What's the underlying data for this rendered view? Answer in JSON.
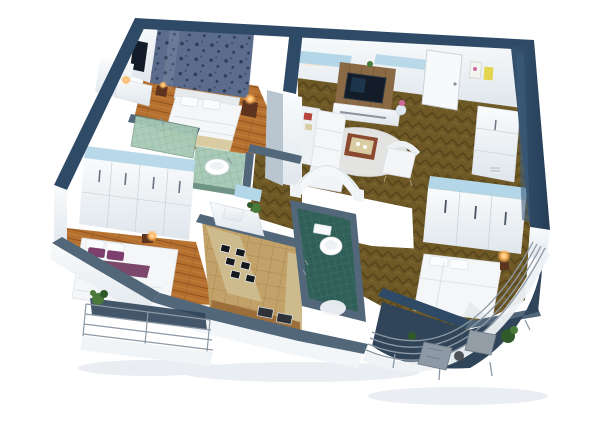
{
  "scene": {
    "title": "3D cutaway floor plan render of a three-bedroom apartment",
    "view": "aerial isometric cutaway, white background",
    "rooms": [
      {
        "id": "bedroom-main",
        "desc": "bedroom with dark patterned accent wall, white double bed, lit nightstand lamps, wall tv, orange wood plank floor"
      },
      {
        "id": "ensuite-bathroom",
        "desc": "green mosaic bathroom with vessel sink on tiled counter and glass shower screen"
      },
      {
        "id": "bedroom-left",
        "desc": "bedroom with white bed, purple pillows and throw, wardrobe wall with drawers, wood plank floor"
      },
      {
        "id": "kitchen",
        "desc": "galley kitchen with six-burner hob, white island with plant, wood counter with trays, beige tile floor"
      },
      {
        "id": "bathroom-central",
        "desc": "teal mosaic bathroom with toilet and white mat"
      },
      {
        "id": "living-room",
        "desc": "living room with corner sofa, wall tv on wood panel, media console, tray coffee table, armchair, rug, herringbone parquet, glass canopy"
      },
      {
        "id": "entry",
        "desc": "entry hall with white front door, two artworks, tall white storage unit"
      },
      {
        "id": "bedroom-right",
        "desc": "bedroom with large white bed, sliding-door wardrobe topped with blue glass, bedside lamp"
      },
      {
        "id": "balcony-left",
        "desc": "straight balcony with metal railing and potted plant"
      },
      {
        "id": "balcony-curved",
        "desc": "curved balcony with metal railing, two grey loungers, side table and plants"
      }
    ]
  },
  "colors": {
    "navy": "#2e4a66",
    "navyLight": "#3d5d7d",
    "slate": "#52677a",
    "slateLight": "#b9c6d0",
    "wallWhite": "#f3f6f8",
    "glassBlue": "#b3d6e8",
    "bedWhite": "#f4f6f8",
    "fixtureWhite": "#ffffff",
    "purple": "#7d3f6d",
    "purpleDark": "#713a60",
    "lampGlow": "#ffb45a",
    "metalRail": "#8d9aa6",
    "plantGreen": "#4a7a3a",
    "plantDarkGreen": "#2f5a28",
    "tvScreen": "#131d29",
    "tvWoodPanel": "#8a6a44",
    "accentRed": "#b5453a",
    "trayBrown": "#8a4a30",
    "trayDark": "#2e3236",
    "counterBeige": "#cdbb8d",
    "counterWood": "#9c6f3a",
    "balconyFloor": "#30455a",
    "fasciaWhite": "#f0f4f7",
    "shadowSoft": "#eaeef2",
    "nightstandBrown": "#5f341f",
    "rug": "#eef0f2",
    "throwBeige": "#d9cba2",
    "artYellow": "#e3d54d",
    "artWhite": "#f4f4f0",
    "flowerPink": "#d06a9a",
    "woodPlank": "#b5702f",
    "parquet": "#6d5826",
    "tileGreen": "#a8cab6",
    "tileTeal": "#2f5f57",
    "kitchenTile": "#c2a268",
    "damaskBase": "#5b6c8c",
    "damaskDot": "#2e3c58"
  }
}
